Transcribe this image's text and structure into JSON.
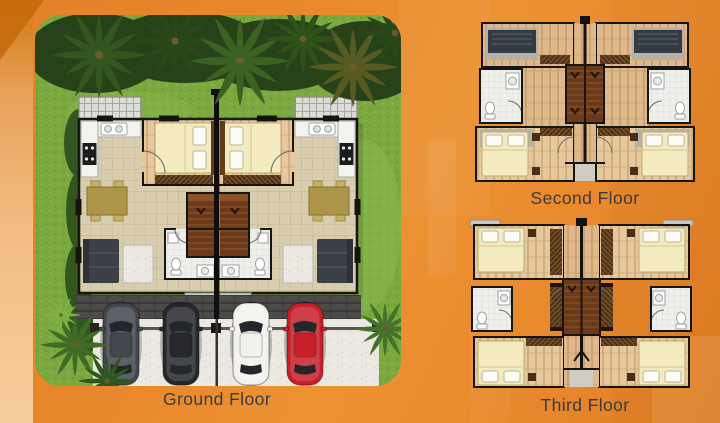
{
  "meta": {
    "asset_type": "floor-plan-brochure-graphic"
  },
  "background": {
    "base_color": "#E8872B",
    "left_band_top": "#CF790F",
    "left_band_bottom": "#F6CD9C",
    "corner_dark": "#C4690D",
    "overlay_light": "#F2A04B"
  },
  "typography": {
    "label_color": "#3B3B3E",
    "label_size_px": 17.5
  },
  "panels": {
    "ground_floor": {
      "label": "Ground Floor",
      "kind": "site-plan-top-view",
      "elements": [
        "lawn",
        "palm-trees",
        "mirrored-twin-unit-plan",
        "pergola",
        "kitchen",
        "dining-set",
        "bed",
        "sofa",
        "bathroom",
        "staircase",
        "driveway",
        "parking-slots"
      ],
      "cars": [
        {
          "name": "car-dark-gray",
          "color": "#43474E"
        },
        {
          "name": "car-black",
          "color": "#26282E"
        },
        {
          "name": "car-white",
          "color": "#F2F1EE"
        },
        {
          "name": "car-red",
          "color": "#C8202A"
        }
      ],
      "palette": {
        "grass": "#7CA840",
        "palm_dark": "#223D16",
        "tile_floor": "#D9CDAF",
        "bedroom_wood": "#E5C496",
        "stairs_wood": "#6D3B1C",
        "driveway": "#4C4B49",
        "parking_concrete": "#EAE8E1"
      }
    },
    "second_floor": {
      "label": "Second Floor",
      "kind": "floor-plan-top-view",
      "elements": [
        "deck-left",
        "deck-right",
        "bathroom-left",
        "bathroom-right",
        "master-bedroom-left",
        "master-bedroom-right",
        "central-staircase",
        "closets",
        "rear-balcony"
      ],
      "palette": {
        "wood": "#DFB98B",
        "bedroom_wood": "#E6C89C",
        "bed": "#F4EAC0",
        "bath": "#EFF0EC",
        "stairs_wood": "#6B3A1B"
      }
    },
    "third_floor": {
      "label": "Third Floor",
      "kind": "floor-plan-top-view",
      "elements": [
        "bedroom-top-left",
        "bedroom-top-right",
        "bedroom-bottom-left",
        "bedroom-bottom-right",
        "bathroom-left",
        "bathroom-right",
        "central-staircase",
        "closets"
      ],
      "palette": {
        "wood": "#DFB98B",
        "bedroom_wood": "#E4C292",
        "bed": "#F4EAC0",
        "bath": "#EFF0EC",
        "stairs_wood": "#6B3A1B"
      }
    }
  }
}
